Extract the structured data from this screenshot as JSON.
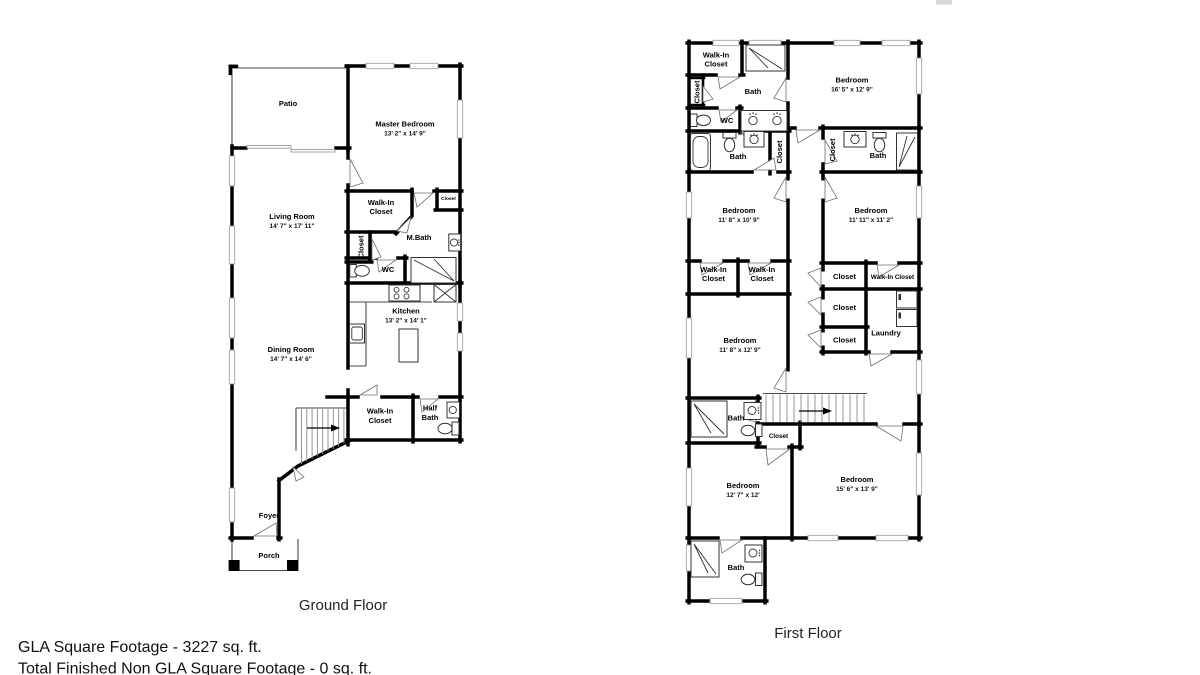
{
  "artifact": {
    "top_right_mark": "#d8d8d8"
  },
  "footer": {
    "line1": "GLA Square Footage - 3227 sq. ft.",
    "line2": "Total Finished Non GLA Square Footage - 0 sq. ft."
  },
  "ground_floor": {
    "title": "Ground Floor",
    "rooms": {
      "patio": {
        "label": "Patio"
      },
      "master_bedroom": {
        "label": "Master Bedroom",
        "dims": "13' 2\" x 14' 9\""
      },
      "living_room": {
        "label": "Living Room",
        "dims": "14' 7\" x 17' 11\""
      },
      "walk_in_closet": {
        "label1": "Walk-In",
        "label2": "Closet"
      },
      "closet_vertical": {
        "label": "Closet"
      },
      "closet_small": {
        "label": "Closet"
      },
      "m_bath": {
        "label": "M.Bath"
      },
      "wc": {
        "label": "WC"
      },
      "kitchen": {
        "label": "Kitchen",
        "dims": "13' 2\" x 14' 1\""
      },
      "dining_room": {
        "label": "Dining Room",
        "dims": "14' 7\" x 14' 6\""
      },
      "walk_in_closet_2": {
        "label1": "Walk-In",
        "label2": "Closet"
      },
      "half_bath": {
        "label1": "Half",
        "label2": "Bath"
      },
      "foyer": {
        "label": "Foyer"
      },
      "porch": {
        "label": "Porch"
      }
    }
  },
  "first_floor": {
    "title": "First Floor",
    "rooms": {
      "walk_in_closet_top": {
        "label1": "Walk-In",
        "label2": "Closet"
      },
      "bath_top": {
        "label": "Bath"
      },
      "closet_left": {
        "label": "Closet"
      },
      "wc": {
        "label": "WC"
      },
      "bath_left": {
        "label": "Bath"
      },
      "closet_hall_left": {
        "label": "Closet"
      },
      "bedroom_1": {
        "label": "Bedroom",
        "dims": "16' 5\" x 12' 9\""
      },
      "closet_hall_right": {
        "label": "Closet"
      },
      "bath_right": {
        "label": "Bath"
      },
      "bedroom_2": {
        "label": "Bedroom",
        "dims": "11' 8\" x 10' 9\""
      },
      "bedroom_3": {
        "label": "Bedroom",
        "dims": "11' 11\" x 11' 2\""
      },
      "wic_a": {
        "label1": "Walk-In",
        "label2": "Closet"
      },
      "wic_b": {
        "label1": "Walk-In",
        "label2": "Closet"
      },
      "closet_r1": {
        "label": "Closet"
      },
      "walk_in_closet_r": {
        "label": "Walk-In Closet"
      },
      "closet_r2": {
        "label": "Closet"
      },
      "closet_r3": {
        "label": "Closet"
      },
      "laundry": {
        "label": "Laundry"
      },
      "bedroom_4": {
        "label": "Bedroom",
        "dims": "11' 8\" x 12' 9\""
      },
      "bath_mid": {
        "label": "Bath"
      },
      "closet_stairs": {
        "label": "Closet"
      },
      "bedroom_5": {
        "label": "Bedroom",
        "dims": "12' 7\" x 12'"
      },
      "bedroom_6": {
        "label": "Bedroom",
        "dims": "15' 6\" x 13' 9\""
      },
      "bath_bottom": {
        "label": "Bath"
      }
    }
  }
}
